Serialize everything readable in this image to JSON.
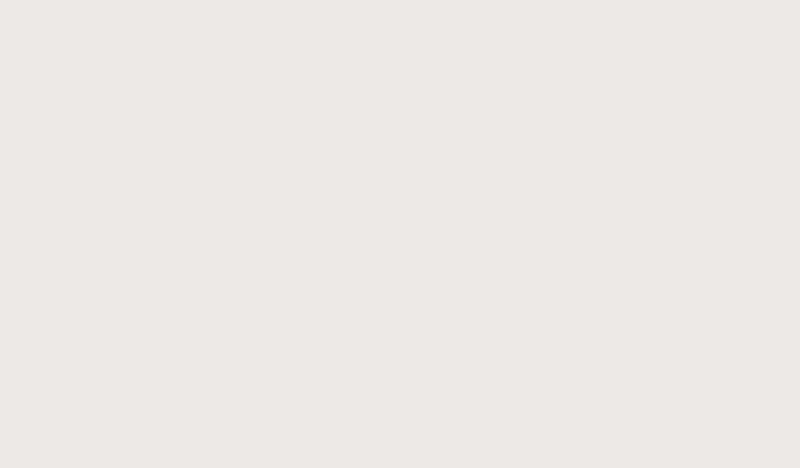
{
  "meta": {
    "type": "3d-isometric-floorplan-render",
    "description": "Photorealistic 3D cutaway floor plan of a three-bedroom apartment with wraparound balcony, viewed from above at an angle. No text or UI chrome is present in the image.",
    "canvas": {
      "width": 800,
      "height": 468
    }
  },
  "palette": {
    "background": "#ece9e6",
    "slab": "#aeb5ab",
    "slab_dark": "#9ba099",
    "slab_tint": "#8f968c",
    "apron_white": "#f3f1ed",
    "wood_floor": "#b4a28d",
    "wood_floor_light": "#c6b6a2",
    "rug_light": "#cdc2b1",
    "rug_ivory": "#f0ebdf",
    "rug_living": "#d7d0c1",
    "wall_white": "#f5f3ef",
    "wall_top": "#fcfbf9",
    "wall_shade": "#e9e6e1",
    "wall_shade2": "#dedbd5",
    "taupe_wall": "#b3a08a",
    "taupe_wall_top": "#c6b49e",
    "door_wood": "#a58c6d",
    "glass": "#cbd2cf",
    "glass_frame": "#7e817a",
    "kitchen_dark": "#5d5042",
    "hood_dark": "#453b31",
    "wood_mid": "#7d6b57",
    "wood_panel": "#5d4a38",
    "wardrobe_dark": "#352d25",
    "clothes_white": "#e8e4da",
    "clothes_tan": "#c2a176",
    "bed_white": "#eae6df",
    "blanket_tan": "#c3a58d",
    "blanket_tan_light": "#d6bca6",
    "blanket_camel": "#8a6a4c",
    "blanket_camel_dark": "#6f4e34",
    "kids_blue_frame": "#9db0c2",
    "kids_shelf_blue": "#8da4b8",
    "kids_blanket": "#c9a87c",
    "sofa": "#c5bcab",
    "sofa_back": "#b0a491",
    "sofa_cushion": "#cfc6b5",
    "cushion_rust": "#9a5a3c",
    "cushion_brown": "#6e604f",
    "pouf_tan": "#c6a67d",
    "navy_chair": "#3a4f63",
    "navy_chair_dark": "#2c4053",
    "coffee_table_base": "#8d947e",
    "marble_white": "#eae8e3",
    "chair_beige": "#c6bdac",
    "stool_maroon": "#7c3a2d",
    "island_white": "#f4f2ee",
    "black": "#2b2723",
    "planter_box": "#3a362f",
    "green_dark": "#3f6030",
    "green_mid": "#5a7d40",
    "green_light": "#77995c",
    "rattan": "#b08550",
    "rattan_dark": "#8a5f36",
    "lemon_yellow": "#d9c55a",
    "gold_tray": "#c7a768"
  },
  "rooms": [
    {
      "id": "balcony-nw",
      "name": "North-west balcony edge",
      "furniture": [
        "glass balustrade",
        "outdoor plants"
      ]
    },
    {
      "id": "kids-bedroom",
      "name": "Kids bedroom",
      "floor": "light wood with ivory round rug",
      "furniture": [
        "two single beds with blue frames",
        "blue bookshelf",
        "teddy bear",
        "wall decor circles",
        "yellow accent rug"
      ]
    },
    {
      "id": "bathroom",
      "name": "Bathroom",
      "furniture": [
        "glass shower enclosure",
        "double vanity",
        "toilet",
        "second vanity"
      ]
    },
    {
      "id": "laundry",
      "name": "Laundry nook",
      "furniture": [
        "washing machine"
      ]
    },
    {
      "id": "entrance-hall",
      "name": "Entrance hall",
      "furniture": [
        "powder room with toilet",
        "hall cabinet",
        "TV console"
      ]
    },
    {
      "id": "kitchen",
      "name": "Kitchen",
      "furniture": [
        "dark L-shaped counter",
        "cooktop",
        "range hood",
        "upper cabinets",
        "refrigerator",
        "breakfast island",
        "two maroon bar stools",
        "tall wood cabinet",
        "entry door"
      ]
    },
    {
      "id": "dining-area",
      "name": "Dining area",
      "furniture": [
        "oval marble dining table",
        "seven beige dining chairs"
      ]
    },
    {
      "id": "master-bedroom",
      "name": "Master bedroom",
      "floor": "wood with light area rug",
      "furniture": [
        "king bed with tan throw",
        "two dark round nightstands",
        "pendant lamp",
        "open wardrobe with hanging clothes",
        "taupe headboard wall",
        "closet wall",
        "curtained balcony door",
        "potted plant"
      ]
    },
    {
      "id": "second-bedroom",
      "name": "Second bedroom",
      "floor": "wood with light area rug",
      "furniture": [
        "double bed with camel throw",
        "white cube nightstand",
        "black round side table",
        "open wardrobe with hanging clothes"
      ]
    },
    {
      "id": "living-room",
      "name": "Living room",
      "floor": "terrazzo with large cream rug",
      "furniture": [
        "L-shaped sectional sofa",
        "rust and brown accent pillows",
        "black round side table",
        "ribbed ottoman",
        "camouflage-marble coffee table with planter and gold tray",
        "tan floor cushion",
        "navy curved armchair",
        "metal side table"
      ]
    },
    {
      "id": "balcony-sw",
      "name": "South-west balcony",
      "furniture": [
        "glass balustrade",
        "bistro table and two wire chairs",
        "white storage cubes",
        "potted palm",
        "hanging egg chair",
        "long planter box with shrubs"
      ]
    }
  ]
}
